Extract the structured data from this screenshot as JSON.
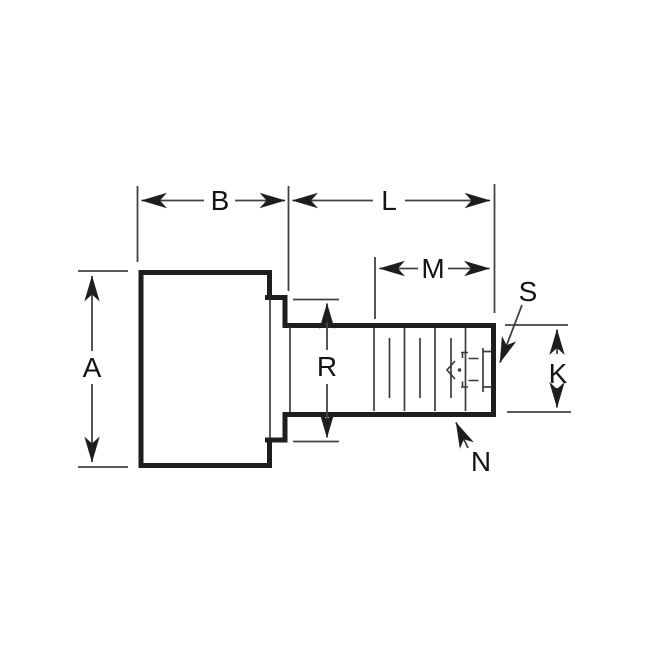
{
  "drawing": {
    "background_color": "#ffffff",
    "line_color": "#1e1e1e",
    "labels": {
      "a": "A",
      "b": "B",
      "l": "L",
      "m": "M",
      "r": "R",
      "s": "S",
      "k": "K",
      "n": "N"
    }
  }
}
